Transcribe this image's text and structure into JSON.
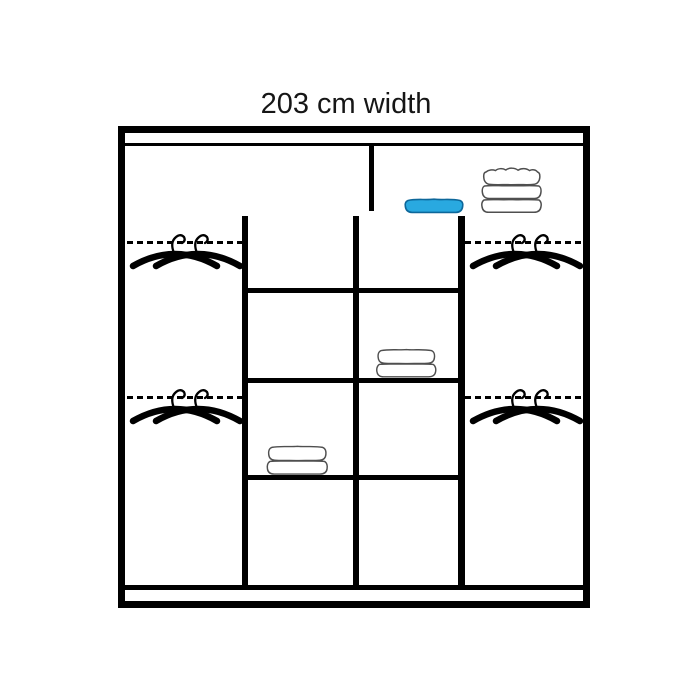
{
  "title": "203 cm width",
  "colors": {
    "line": "#000000",
    "towel_outline": "#4f4f4f",
    "blue_fill": "#29a9e0",
    "blue_outline": "#0d679a"
  },
  "wardrobe": {
    "width_label": "203 cm width",
    "top_section": {
      "left_compartment": "empty",
      "right_compartment_items": [
        "folded-blue-cloth",
        "stack-of-three-folded-towels"
      ]
    },
    "columns": [
      {
        "id": "left",
        "type": "hanging",
        "rails": 2,
        "hangers_per_rail": 2
      },
      {
        "id": "middle-left",
        "type": "shelves",
        "compartments": 4,
        "towel_in_compartment": 3
      },
      {
        "id": "middle-right",
        "type": "shelves",
        "compartments": 4,
        "towel_in_compartment": 2
      },
      {
        "id": "right",
        "type": "hanging",
        "rails": 2,
        "hangers_per_rail": 2
      }
    ]
  }
}
